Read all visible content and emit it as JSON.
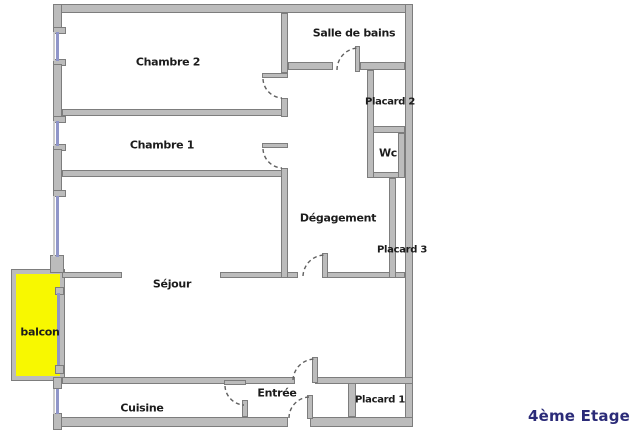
{
  "plan": {
    "rooms": {
      "chambre2": "Chambre 2",
      "chambre1": "Chambre 1",
      "salle_de_bains": "Salle de bains",
      "placard2": "Placard 2",
      "wc": "Wc",
      "degagement": "Dégagement",
      "placard3": "Placard 3",
      "sejour": "Séjour",
      "balcon": "balcon",
      "cuisine": "Cuisine",
      "entree": "Entrée",
      "placard1": "Placard 1"
    },
    "floor_label": "4ème Etage",
    "colors": {
      "wall_fill": "#bcbcbc",
      "wall_edge": "#7d7d7d",
      "window_glass": "#8f95c9",
      "window_outer": "#cccccc",
      "balcony_fill": "#f8f800",
      "door_arc": "#606060",
      "room_label": "#1c1c1c",
      "floor_label_color": "#2b2b78",
      "background": "#ffffff"
    }
  }
}
